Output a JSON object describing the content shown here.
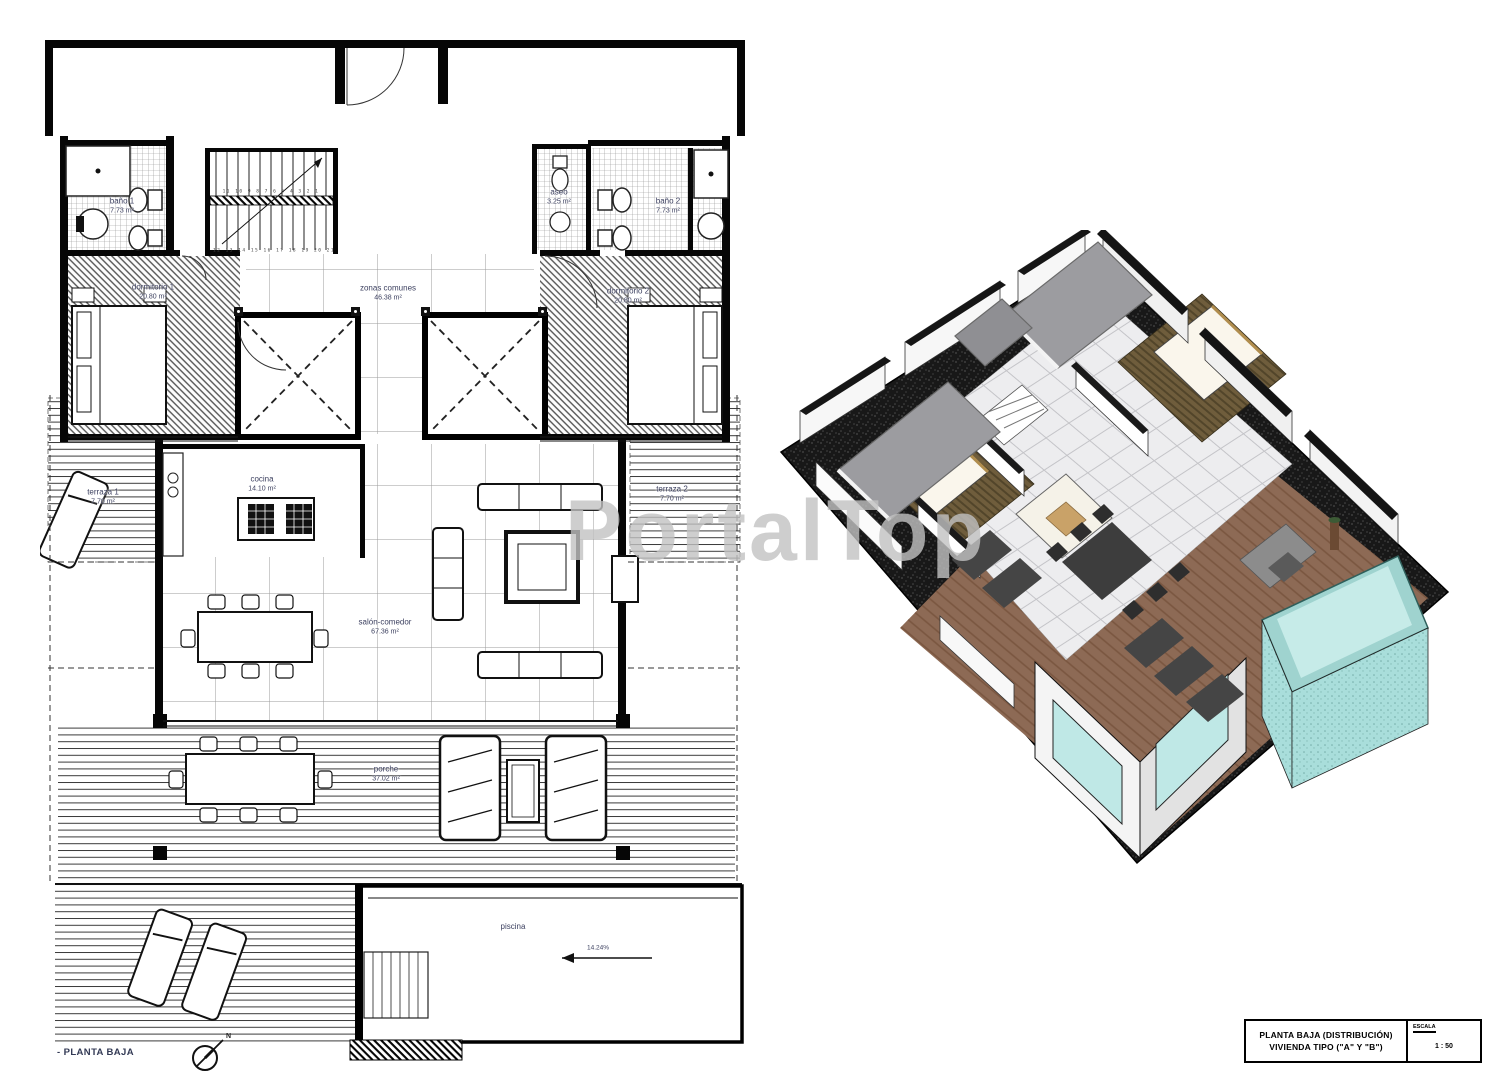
{
  "watermark": "PortalTop",
  "plan": {
    "rooms": {
      "bano1": {
        "name": "baño 1",
        "area": "7.73 m²"
      },
      "aseo": {
        "name": "aseo",
        "area": "3.25 m²"
      },
      "bano2": {
        "name": "baño 2",
        "area": "7.73 m²"
      },
      "dormitorio1": {
        "name": "dormitorio 1",
        "area": "20.80 m²"
      },
      "dormitorio2": {
        "name": "dormitorio 2",
        "area": "20.80 m²"
      },
      "zonas_comunes": {
        "name": "zonas comunes",
        "area": "46.38 m²"
      },
      "cocina": {
        "name": "cocina",
        "area": "14.10 m²"
      },
      "terraza1": {
        "name": "terraza 1",
        "area": "7.70 m²"
      },
      "terraza2": {
        "name": "terraza 2",
        "area": "7.70 m²"
      },
      "salon_comedor": {
        "name": "salón-comedor",
        "area": "67.36 m²"
      },
      "porche": {
        "name": "porche",
        "area": "37.02 m²"
      },
      "piscina": {
        "name": "piscina"
      }
    },
    "stairs": {
      "top_numbers": "11 10 9 8 7 6 5 4 3 2 1",
      "bottom_numbers": "12 13 14 15 16 17 18 19 20 21"
    },
    "pool_slope": "14.24%",
    "footer_label": "- PLANTA BAJA",
    "north_label": "N"
  },
  "title_block": {
    "line1": "PLANTA BAJA (DISTRIBUCIÓN)",
    "line2": "VIVIENDA TIPO (\"A\" Y \"B\")",
    "scale_label": "ESCALA",
    "scale_value": "1 : 50"
  },
  "colors": {
    "deck_wood": "#8d6a55",
    "pool_rim": "#9fd3cf",
    "pool_water": "#c6ebe8",
    "glass": "#bfe8e6",
    "roof_gray": "#9c9ca0",
    "base_black": "#171717",
    "bed_floor": "#6f5d3c",
    "label_ink": "#3d4160"
  }
}
